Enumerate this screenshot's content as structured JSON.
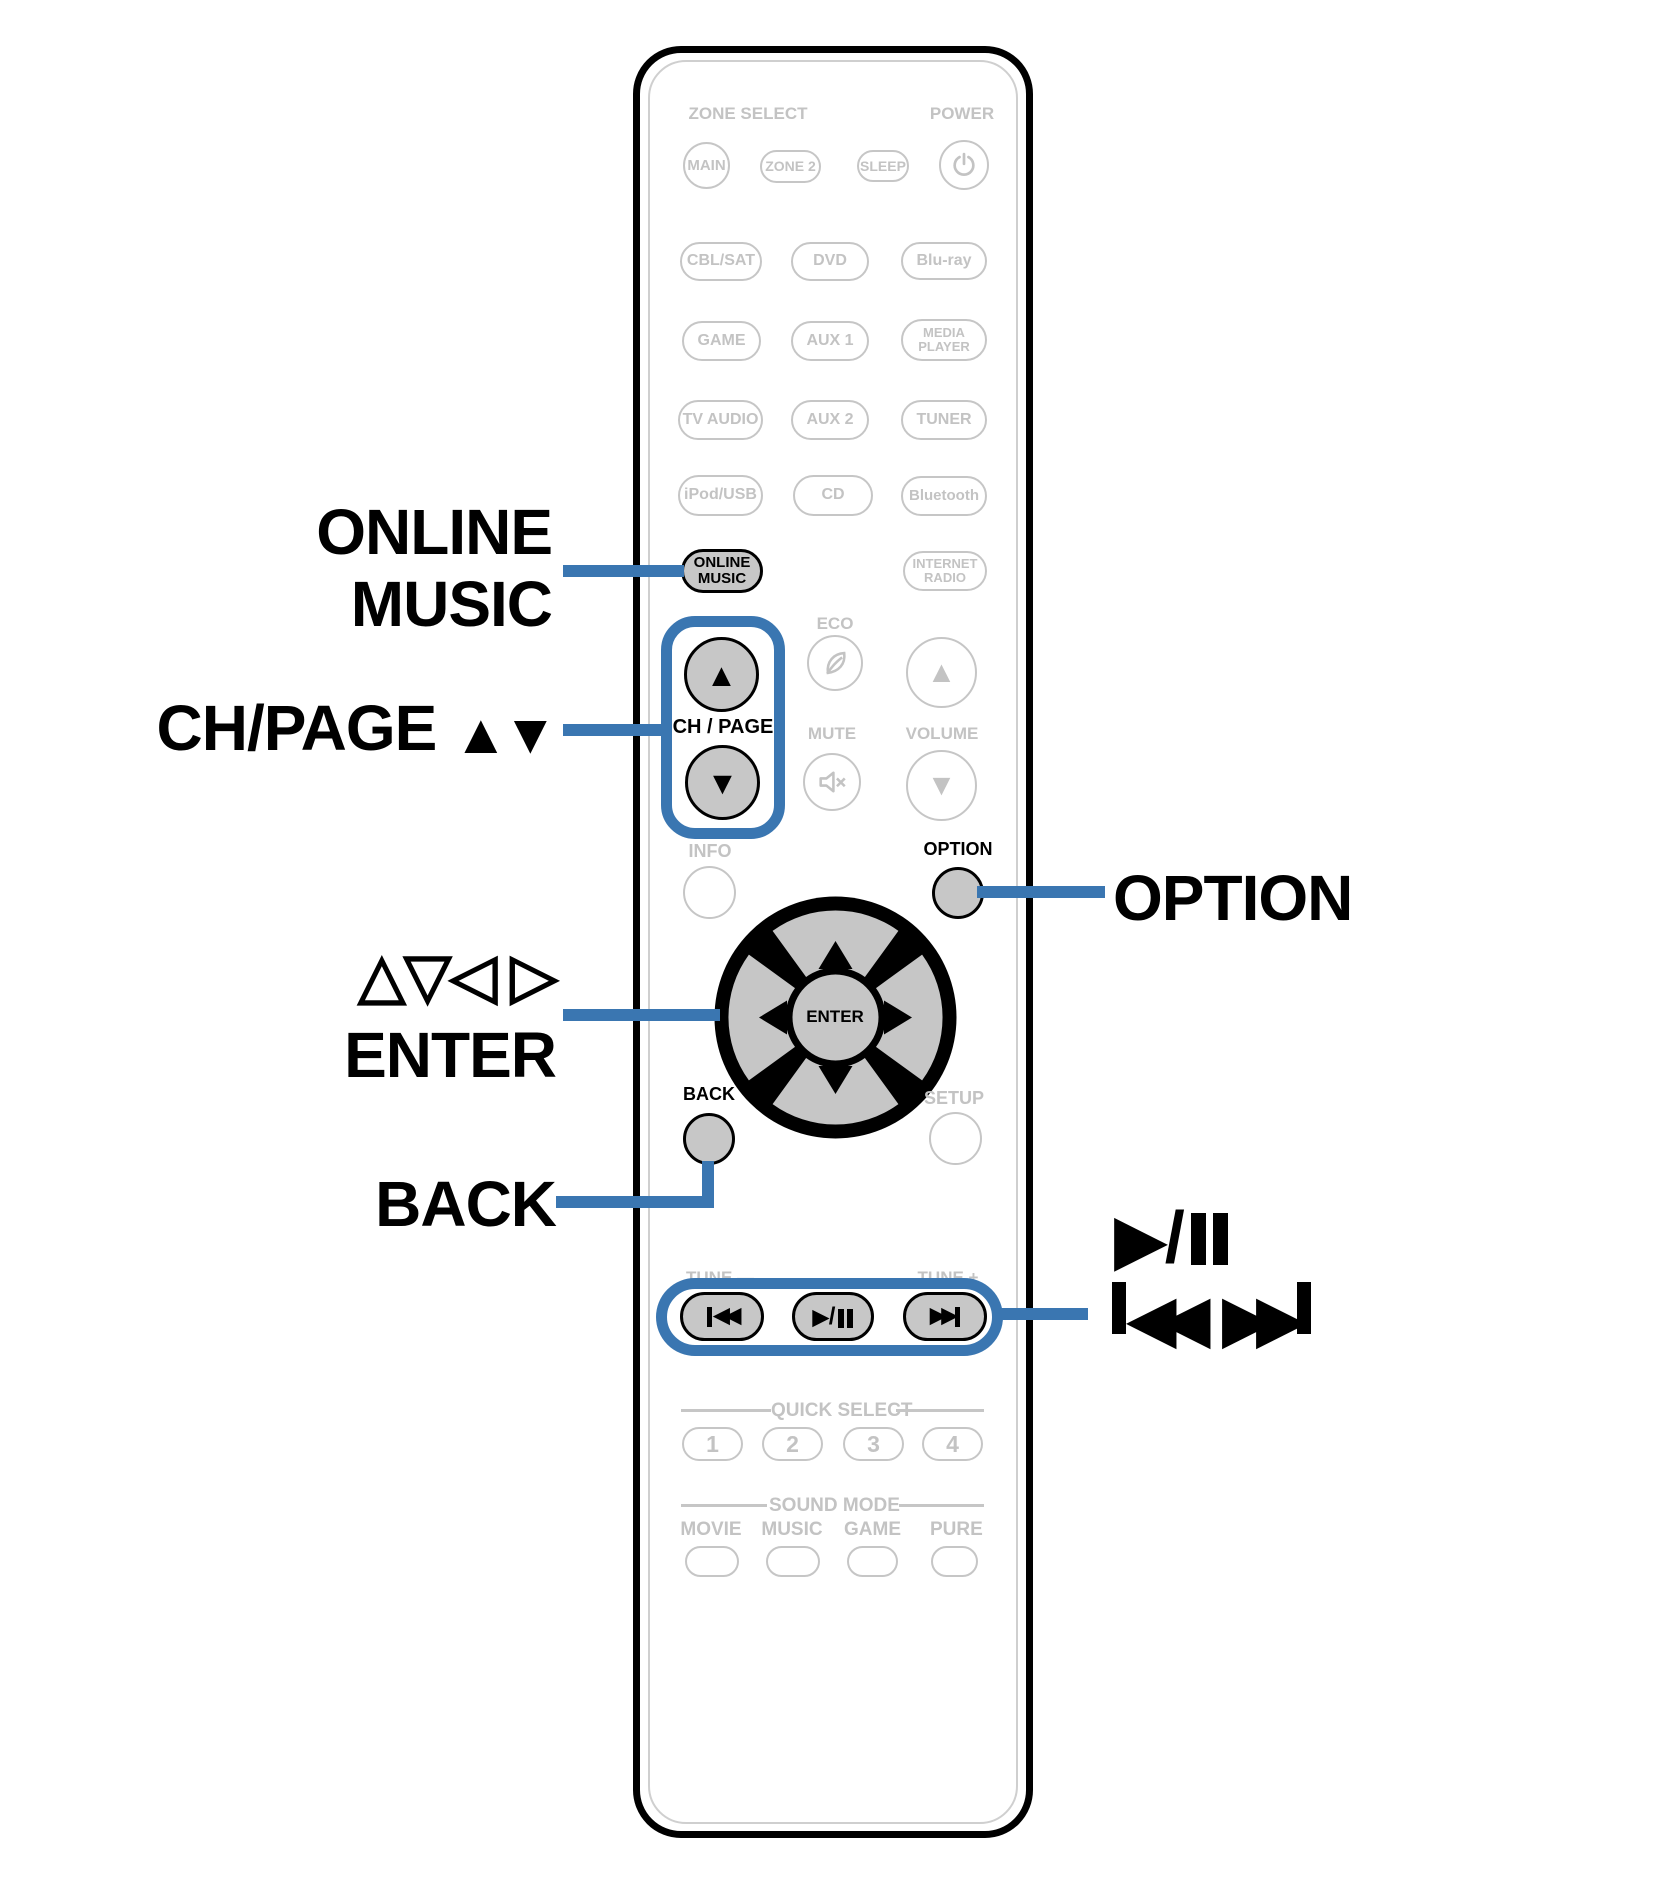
{
  "colors": {
    "accent_blue": "#3a76b1",
    "inactive_gray": "#c3c3c3",
    "button_fill": "#c7c7c7"
  },
  "callouts": {
    "online_music": {
      "line1": "ONLINE",
      "line2": "MUSIC"
    },
    "ch_page": {
      "text": "CH/PAGE",
      "arrows": "▲▼"
    },
    "cursor": {
      "triangles": "△▽◁ ▷",
      "enter": "ENTER"
    },
    "back": "BACK",
    "option": "OPTION",
    "play_pause": {
      "play_glyph": "▶",
      "slash": "/"
    },
    "skip": {
      "back_glyph": "◀◀",
      "fwd_glyph": "▶▶"
    }
  },
  "remote": {
    "zone_select_label": "ZONE SELECT",
    "power_label": "POWER",
    "zone_buttons": [
      "MAIN",
      "ZONE 2",
      "SLEEP"
    ],
    "sources": [
      "CBL/SAT",
      "DVD",
      "Blu-ray",
      "GAME",
      "AUX 1",
      "MEDIA PLAYER",
      "TV AUDIO",
      "AUX 2",
      "TUNER",
      "iPod/USB",
      "CD",
      "Bluetooth"
    ],
    "online_music_button": "ONLINE MUSIC",
    "internet_radio_button": "INTERNET RADIO",
    "eco_label": "ECO",
    "ch_page_label": "CH / PAGE",
    "mute_label": "MUTE",
    "volume_label": "VOLUME",
    "info_label": "INFO",
    "option_label": "OPTION",
    "enter_button": "ENTER",
    "back_label": "BACK",
    "setup_label": "SETUP",
    "tune_minus_label": "TUNE —",
    "tune_plus_label": "TUNE +",
    "quick_select_label": "QUICK SELECT",
    "quick_buttons": [
      "1",
      "2",
      "3",
      "4"
    ],
    "sound_mode_label": "SOUND MODE",
    "sound_mode_buttons": [
      "MOVIE",
      "MUSIC",
      "GAME",
      "PURE"
    ],
    "glyphs": {
      "up": "▲",
      "down": "▼",
      "skip_back": "◀◀",
      "skip_fwd": "▶▶",
      "play": "▶",
      "slash": "/"
    }
  }
}
